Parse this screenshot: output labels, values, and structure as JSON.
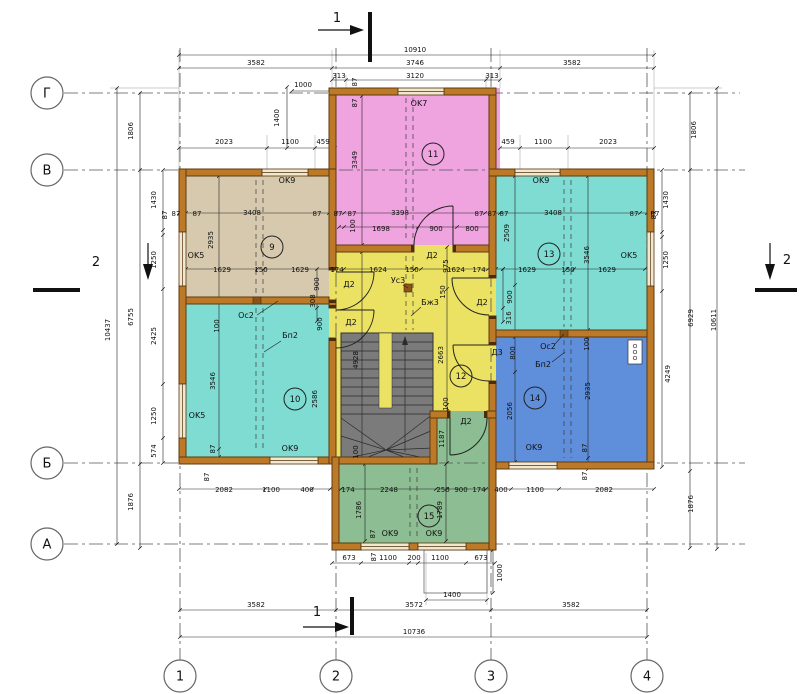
{
  "drawing": {
    "kind": "architectural floor plan",
    "rooms_numbered": [
      "9",
      "10",
      "11",
      "12",
      "13",
      "14",
      "15"
    ]
  },
  "colors": {
    "wall": "#bc7a28",
    "wall_edge": "#5f3a0e",
    "room9_beige": "#d6c9ae",
    "room10_teal": "#7edcd2",
    "room11_pink": "#efa3df",
    "room12_yellow": "#ebe163",
    "room13_teal": "#7edcd2",
    "room14_blue": "#5f8edb",
    "room15_green": "#8dbd92",
    "stairs_gray": "#7b7b7b"
  },
  "axis_bubbles": {
    "left": [
      {
        "label": "Г",
        "x": 47,
        "y": 93
      },
      {
        "label": "В",
        "x": 47,
        "y": 170
      },
      {
        "label": "Б",
        "x": 47,
        "y": 463
      },
      {
        "label": "А",
        "x": 47,
        "y": 544
      }
    ],
    "bottom": [
      {
        "label": "1",
        "x": 180,
        "y": 676
      },
      {
        "label": "2",
        "x": 336,
        "y": 676
      },
      {
        "label": "3",
        "x": 491,
        "y": 676
      },
      {
        "label": "4",
        "x": 647,
        "y": 676
      }
    ]
  },
  "room_numbers": [
    {
      "n": "9",
      "x": 272,
      "y": 247
    },
    {
      "n": "10",
      "x": 295,
      "y": 399
    },
    {
      "n": "11",
      "x": 433,
      "y": 154
    },
    {
      "n": "12",
      "x": 461,
      "y": 376
    },
    {
      "n": "13",
      "x": 549,
      "y": 254
    },
    {
      "n": "14",
      "x": 535,
      "y": 398
    },
    {
      "n": "15",
      "x": 429,
      "y": 516
    }
  ],
  "section_marks": [
    {
      "label": "1",
      "x": 337,
      "y": 22
    },
    {
      "label": "1",
      "x": 317,
      "y": 616
    },
    {
      "label": "2",
      "x": 96,
      "y": 266
    },
    {
      "label": "2",
      "x": 787,
      "y": 264
    }
  ],
  "labels": [
    {
      "t": "10910",
      "x": 415,
      "y": 52
    },
    {
      "t": "3582",
      "x": 256,
      "y": 65
    },
    {
      "t": "3746",
      "x": 415,
      "y": 65
    },
    {
      "t": "3582",
      "x": 572,
      "y": 65
    },
    {
      "t": "313",
      "x": 339,
      "y": 78
    },
    {
      "t": "3120",
      "x": 415,
      "y": 78
    },
    {
      "t": "313",
      "x": 492,
      "y": 78
    },
    {
      "t": "1000",
      "x": 303,
      "y": 87
    },
    {
      "t": "87",
      "x": 357,
      "y": 82,
      "r": -90
    },
    {
      "t": "87",
      "x": 357,
      "y": 103,
      "r": -90
    },
    {
      "t": "2023",
      "x": 224,
      "y": 144
    },
    {
      "t": "1100",
      "x": 290,
      "y": 144
    },
    {
      "t": "459",
      "x": 323,
      "y": 144
    },
    {
      "t": "1400",
      "x": 279,
      "y": 118,
      "r": -90
    },
    {
      "t": "459",
      "x": 508,
      "y": 144
    },
    {
      "t": "1100",
      "x": 543,
      "y": 144
    },
    {
      "t": "2023",
      "x": 608,
      "y": 144
    },
    {
      "t": "1806",
      "x": 133,
      "y": 131,
      "r": -90
    },
    {
      "t": "10437",
      "x": 110,
      "y": 330,
      "r": -90
    },
    {
      "t": "6755",
      "x": 133,
      "y": 317,
      "r": -90
    },
    {
      "t": "1430",
      "x": 156,
      "y": 200,
      "r": -90
    },
    {
      "t": "87",
      "x": 167,
      "y": 215,
      "r": -90
    },
    {
      "t": "1250",
      "x": 156,
      "y": 260,
      "r": -90
    },
    {
      "t": "2425",
      "x": 156,
      "y": 336,
      "r": -90
    },
    {
      "t": "1250",
      "x": 156,
      "y": 416,
      "r": -90
    },
    {
      "t": "574",
      "x": 156,
      "y": 451,
      "r": -90
    },
    {
      "t": "1876",
      "x": 133,
      "y": 502,
      "r": -90
    },
    {
      "t": "1806",
      "x": 696,
      "y": 130,
      "r": -90
    },
    {
      "t": "1430",
      "x": 668,
      "y": 200,
      "r": -90
    },
    {
      "t": "87",
      "x": 656,
      "y": 215,
      "r": -90
    },
    {
      "t": "1250",
      "x": 668,
      "y": 260,
      "r": -90
    },
    {
      "t": "6929",
      "x": 693,
      "y": 318,
      "r": -90
    },
    {
      "t": "10611",
      "x": 716,
      "y": 320,
      "r": -90
    },
    {
      "t": "4249",
      "x": 670,
      "y": 374,
      "r": -90
    },
    {
      "t": "1876",
      "x": 693,
      "y": 504,
      "r": -90
    },
    {
      "t": "87",
      "x": 176,
      "y": 216
    },
    {
      "t": "87",
      "x": 197,
      "y": 216
    },
    {
      "t": "3408",
      "x": 252,
      "y": 215
    },
    {
      "t": "87",
      "x": 317,
      "y": 216
    },
    {
      "t": "87",
      "x": 338,
      "y": 216
    },
    {
      "t": "87",
      "x": 352,
      "y": 216
    },
    {
      "t": "3398",
      "x": 400,
      "y": 215
    },
    {
      "t": "87",
      "x": 479,
      "y": 216
    },
    {
      "t": "87",
      "x": 492,
      "y": 216
    },
    {
      "t": "87",
      "x": 504,
      "y": 216
    },
    {
      "t": "3408",
      "x": 553,
      "y": 215
    },
    {
      "t": "87",
      "x": 634,
      "y": 216
    },
    {
      "t": "87",
      "x": 655,
      "y": 216
    },
    {
      "t": "100",
      "x": 355,
      "y": 226,
      "r": -90
    },
    {
      "t": "1698",
      "x": 381,
      "y": 231
    },
    {
      "t": "900",
      "x": 436,
      "y": 231
    },
    {
      "t": "800",
      "x": 472,
      "y": 231
    },
    {
      "t": "OK9",
      "x": 287,
      "y": 183
    },
    {
      "t": "2935",
      "x": 213,
      "y": 240,
      "r": -90
    },
    {
      "t": "OK5",
      "x": 196,
      "y": 258
    },
    {
      "t": "1629",
      "x": 222,
      "y": 272
    },
    {
      "t": "150",
      "x": 261,
      "y": 272
    },
    {
      "t": "1629",
      "x": 300,
      "y": 272
    },
    {
      "t": "900",
      "x": 319,
      "y": 284,
      "r": -90
    },
    {
      "t": "308",
      "x": 315,
      "y": 301,
      "r": -90
    },
    {
      "t": "Ос2",
      "x": 246,
      "y": 318
    },
    {
      "t": "174",
      "x": 337,
      "y": 272
    },
    {
      "t": "1624",
      "x": 378,
      "y": 272
    },
    {
      "t": "150",
      "x": 412,
      "y": 272
    },
    {
      "t": "1624",
      "x": 456,
      "y": 272
    },
    {
      "t": "174",
      "x": 479,
      "y": 272
    },
    {
      "t": "Д2",
      "x": 432,
      "y": 258
    },
    {
      "t": "975",
      "x": 448,
      "y": 266,
      "r": -90
    },
    {
      "t": "Д2",
      "x": 349,
      "y": 287
    },
    {
      "t": "Ус3",
      "x": 398,
      "y": 283
    },
    {
      "t": "150",
      "x": 445,
      "y": 292,
      "r": -90
    },
    {
      "t": "Бж3",
      "x": 430,
      "y": 305
    },
    {
      "t": "Д2",
      "x": 351,
      "y": 325
    },
    {
      "t": "Д2",
      "x": 482,
      "y": 305
    },
    {
      "t": "4928",
      "x": 358,
      "y": 360,
      "r": -90
    },
    {
      "t": "2663",
      "x": 443,
      "y": 355,
      "r": -90
    },
    {
      "t": "100",
      "x": 448,
      "y": 404,
      "r": -90
    },
    {
      "t": "Д2",
      "x": 466,
      "y": 424
    },
    {
      "t": "1187",
      "x": 444,
      "y": 439,
      "r": -90
    },
    {
      "t": "100",
      "x": 358,
      "y": 452,
      "r": -90
    },
    {
      "t": "100",
      "x": 219,
      "y": 326,
      "r": -90
    },
    {
      "t": "900",
      "x": 322,
      "y": 324,
      "r": -90
    },
    {
      "t": "Бп2",
      "x": 290,
      "y": 338
    },
    {
      "t": "3546",
      "x": 215,
      "y": 381,
      "r": -90
    },
    {
      "t": "2586",
      "x": 317,
      "y": 399,
      "r": -90
    },
    {
      "t": "OK5",
      "x": 197,
      "y": 418
    },
    {
      "t": "87",
      "x": 215,
      "y": 449,
      "r": -90
    },
    {
      "t": "OK9",
      "x": 290,
      "y": 451
    },
    {
      "t": "OK7",
      "x": 419,
      "y": 106
    },
    {
      "t": "3349",
      "x": 357,
      "y": 160,
      "r": -90
    },
    {
      "t": "OK9",
      "x": 541,
      "y": 183
    },
    {
      "t": "2509",
      "x": 509,
      "y": 233,
      "r": -90
    },
    {
      "t": "3546",
      "x": 589,
      "y": 255,
      "r": -90
    },
    {
      "t": "OK5",
      "x": 629,
      "y": 258
    },
    {
      "t": "1629",
      "x": 527,
      "y": 272
    },
    {
      "t": "150",
      "x": 568,
      "y": 272
    },
    {
      "t": "1629",
      "x": 607,
      "y": 272
    },
    {
      "t": "900",
      "x": 512,
      "y": 297,
      "r": -90
    },
    {
      "t": "316",
      "x": 511,
      "y": 318,
      "r": -90
    },
    {
      "t": "Д3",
      "x": 497,
      "y": 355
    },
    {
      "t": "800",
      "x": 515,
      "y": 353,
      "r": -90
    },
    {
      "t": "Ос2",
      "x": 548,
      "y": 349
    },
    {
      "t": "Бп2",
      "x": 543,
      "y": 367
    },
    {
      "t": "100",
      "x": 589,
      "y": 344,
      "r": -90
    },
    {
      "t": "2935",
      "x": 590,
      "y": 391,
      "r": -90
    },
    {
      "t": "2056",
      "x": 512,
      "y": 411,
      "r": -90
    },
    {
      "t": "OK9",
      "x": 534,
      "y": 450
    },
    {
      "t": "87",
      "x": 587,
      "y": 448,
      "r": -90
    },
    {
      "t": "87",
      "x": 209,
      "y": 477,
      "r": -90
    },
    {
      "t": "2082",
      "x": 224,
      "y": 492
    },
    {
      "t": "1100",
      "x": 271,
      "y": 492
    },
    {
      "t": "400",
      "x": 307,
      "y": 492
    },
    {
      "t": "174",
      "x": 348,
      "y": 492
    },
    {
      "t": "2248",
      "x": 389,
      "y": 492
    },
    {
      "t": "250",
      "x": 443,
      "y": 492
    },
    {
      "t": "900",
      "x": 461,
      "y": 492
    },
    {
      "t": "174",
      "x": 479,
      "y": 492
    },
    {
      "t": "400",
      "x": 501,
      "y": 492
    },
    {
      "t": "1100",
      "x": 535,
      "y": 492
    },
    {
      "t": "2082",
      "x": 604,
      "y": 492
    },
    {
      "t": "87",
      "x": 587,
      "y": 476,
      "r": -90
    },
    {
      "t": "1786",
      "x": 361,
      "y": 510,
      "r": -90
    },
    {
      "t": "1789",
      "x": 442,
      "y": 510,
      "r": -90
    },
    {
      "t": "87",
      "x": 375,
      "y": 534,
      "r": -90
    },
    {
      "t": "OK9",
      "x": 390,
      "y": 536
    },
    {
      "t": "OK9",
      "x": 434,
      "y": 536
    },
    {
      "t": "673",
      "x": 349,
      "y": 560
    },
    {
      "t": "87",
      "x": 376,
      "y": 557,
      "r": -90
    },
    {
      "t": "1100",
      "x": 388,
      "y": 560
    },
    {
      "t": "200",
      "x": 414,
      "y": 560
    },
    {
      "t": "1100",
      "x": 440,
      "y": 560
    },
    {
      "t": "673",
      "x": 481,
      "y": 560
    },
    {
      "t": "1000",
      "x": 502,
      "y": 573,
      "r": -90
    },
    {
      "t": "1400",
      "x": 452,
      "y": 597
    },
    {
      "t": "3582",
      "x": 256,
      "y": 607
    },
    {
      "t": "3572",
      "x": 414,
      "y": 607
    },
    {
      "t": "3582",
      "x": 571,
      "y": 607
    },
    {
      "t": "10736",
      "x": 414,
      "y": 634
    }
  ]
}
